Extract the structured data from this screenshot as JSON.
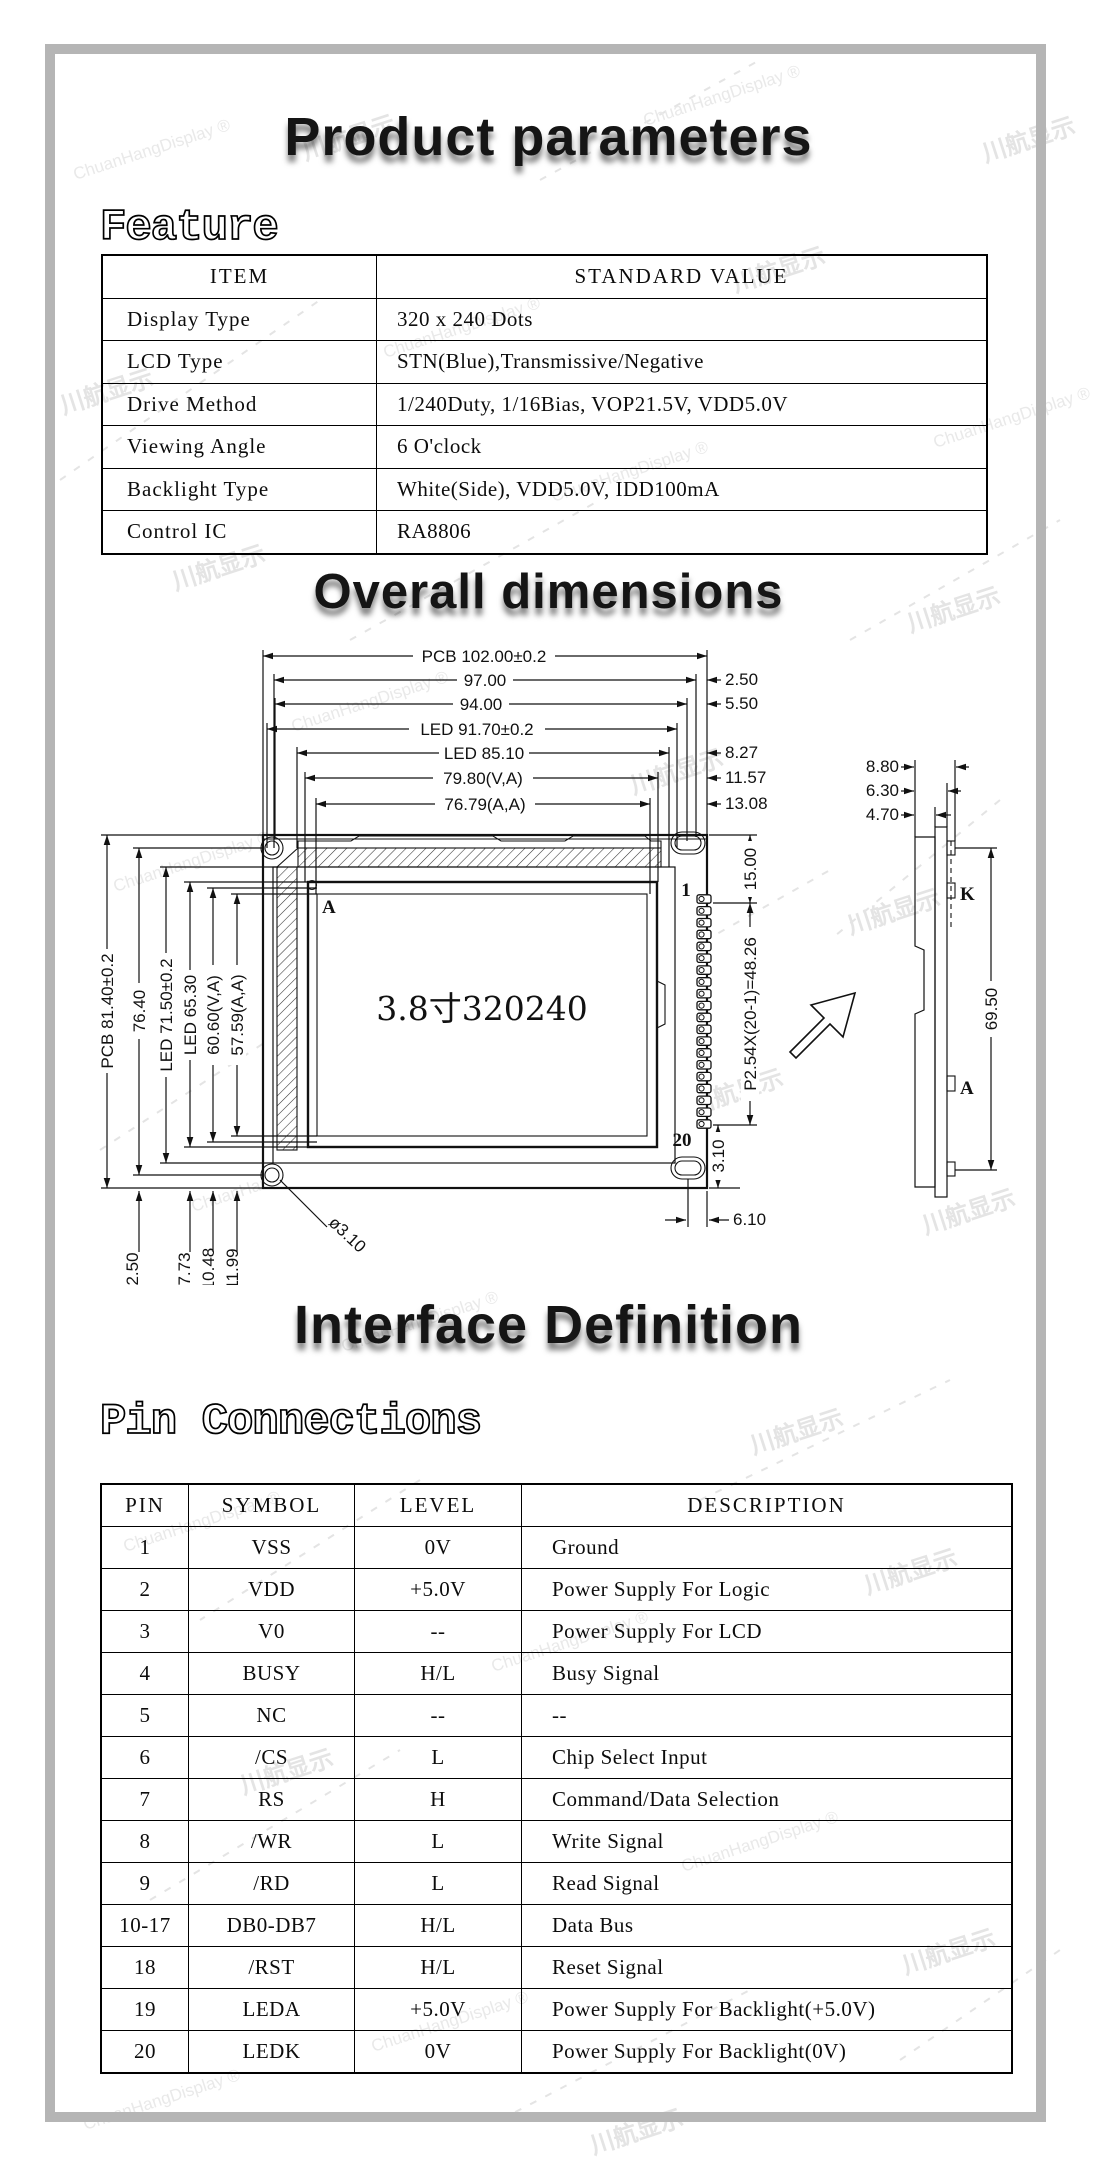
{
  "page": {
    "title1": "Product parameters",
    "section_feature": "Feature",
    "title2": "Overall dimensions",
    "title3": "Interface Definition",
    "section_pins": "Pin Connections"
  },
  "watermark": {
    "cn": "川航显示",
    "en": "ChuanHangDisplay ®"
  },
  "feature_table": {
    "headers": [
      "ITEM",
      "STANDARD VALUE"
    ],
    "rows": [
      [
        "Display Type",
        "320 x 240 Dots"
      ],
      [
        "LCD Type",
        "STN(Blue),Transmissive/Negative"
      ],
      [
        "Drive Method",
        "1/240Duty, 1/16Bias, VOP21.5V, VDD5.0V"
      ],
      [
        "Viewing Angle",
        "6 O'clock"
      ],
      [
        "Backlight Type",
        "White(Side), VDD5.0V, IDD100mA"
      ],
      [
        "Control IC",
        "RA8806"
      ]
    ]
  },
  "drawing": {
    "top_dims": [
      "PCB 102.00±0.2",
      "97.00",
      "94.00",
      "LED 91.70±0.2",
      "LED 85.10",
      "79.80(V,A)",
      "76.79(A,A)"
    ],
    "right_offset_dims": [
      "2.50",
      "5.50",
      "8.27",
      "11.57",
      "13.08"
    ],
    "left_dims": [
      "PCB 81.40±0.2",
      "76.40",
      "LED 71.50±0.2",
      "LED 65.30",
      "60.60(V,A)",
      "57.59(A,A)"
    ],
    "bottom_dims": [
      "2.50",
      "7.73",
      "10.48",
      "11.99"
    ],
    "hole_dim": "ø3.10",
    "screen_label": "3.8寸320240",
    "corner_marker": "A",
    "pin_first": "1",
    "pin_last": "20",
    "pin_top_dim": "15.00",
    "pin_pitch_dim": "P2.54X(20-1)=48.26",
    "pin_bottom_dim": "3.10",
    "hole_offset_dim": "6.10",
    "side_view": {
      "thickness_dims": [
        "8.80",
        "6.30",
        "4.70"
      ],
      "height_dim": "69.50",
      "pin_k": "K",
      "pin_a": "A"
    }
  },
  "pin_table": {
    "headers": [
      "PIN",
      "SYMBOL",
      "LEVEL",
      "DESCRIPTION"
    ],
    "rows": [
      [
        "1",
        "VSS",
        "0V",
        "Ground"
      ],
      [
        "2",
        "VDD",
        "+5.0V",
        "Power Supply For Logic"
      ],
      [
        "3",
        "V0",
        "--",
        "Power Supply For LCD"
      ],
      [
        "4",
        "BUSY",
        "H/L",
        "Busy Signal"
      ],
      [
        "5",
        "NC",
        "--",
        "--"
      ],
      [
        "6",
        "/CS",
        "L",
        "Chip Select Input"
      ],
      [
        "7",
        "RS",
        "H",
        "Command/Data Selection"
      ],
      [
        "8",
        "/WR",
        "L",
        "Write Signal"
      ],
      [
        "9",
        "/RD",
        "L",
        "Read Signal"
      ],
      [
        "10-17",
        "DB0-DB7",
        "H/L",
        "Data Bus"
      ],
      [
        "18",
        "/RST",
        "H/L",
        "Reset Signal"
      ],
      [
        "19",
        "LEDA",
        "+5.0V",
        "Power Supply For Backlight(+5.0V)"
      ],
      [
        "20",
        "LEDK",
        "0V",
        "Power Supply For Backlight(0V)"
      ]
    ]
  }
}
